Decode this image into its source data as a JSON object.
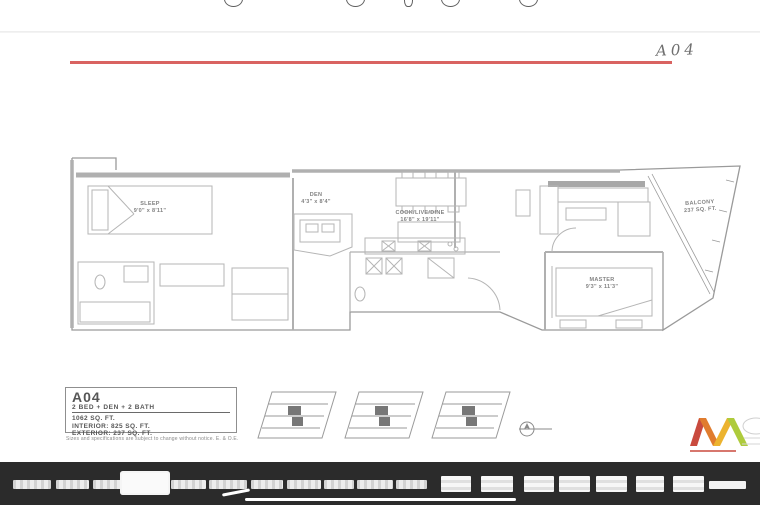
{
  "annotation": {
    "text": "A04"
  },
  "toolbar": {
    "icon_count": 5
  },
  "floorplan": {
    "accent_line_color": "#d96361",
    "rooms": {
      "sleep": {
        "name": "SLEEP",
        "dims": "9'0\" x 8'11\""
      },
      "den": {
        "name": "DEN",
        "dims": "4'3\" x 8'4\""
      },
      "cook": {
        "name": "COOK/LIVE/DINE",
        "dims": "16'8\" x 19'11\""
      },
      "master": {
        "name": "MASTER",
        "dims": "9'3\" x 11'3\""
      },
      "balcony": {
        "name": "BALCONY",
        "dims": "237 SQ. FT."
      }
    },
    "info_box": {
      "unit": "A04",
      "type": "2 BED + DEN + 2 BATH",
      "area": "1062 SQ. FT.",
      "interior": "INTERIOR: 825 SQ. FT.",
      "exterior": "EXTERIOR: 237 SQ. FT."
    },
    "disclaimer": "Sizes and specifications are subject to change without notice. E. & O.E."
  },
  "logo_colors": {
    "red": "#c94a3e",
    "orange": "#e07c2e",
    "yellow": "#ecb32f",
    "green": "#aecb3c"
  },
  "thumbnail_strip": {
    "bg": "#2b2b2b",
    "selected_index": 3,
    "items": [
      {
        "x": 13,
        "y": 18,
        "w": 38,
        "h": 9,
        "kind": "small"
      },
      {
        "x": 56,
        "y": 18,
        "w": 33,
        "h": 9,
        "kind": "small"
      },
      {
        "x": 93,
        "y": 18,
        "w": 28,
        "h": 9,
        "kind": "small"
      },
      {
        "x": 122,
        "y": 11,
        "w": 46,
        "h": 20,
        "kind": "selected"
      },
      {
        "x": 171,
        "y": 18,
        "w": 35,
        "h": 9,
        "kind": "small"
      },
      {
        "x": 209,
        "y": 18,
        "w": 38,
        "h": 9,
        "kind": "small"
      },
      {
        "x": 251,
        "y": 18,
        "w": 32,
        "h": 9,
        "kind": "small"
      },
      {
        "x": 287,
        "y": 18,
        "w": 34,
        "h": 9,
        "kind": "small"
      },
      {
        "x": 324,
        "y": 18,
        "w": 30,
        "h": 9,
        "kind": "small"
      },
      {
        "x": 357,
        "y": 18,
        "w": 36,
        "h": 9,
        "kind": "small"
      },
      {
        "x": 396,
        "y": 18,
        "w": 31,
        "h": 9,
        "kind": "small"
      },
      {
        "x": 441,
        "y": 14,
        "w": 30,
        "h": 16,
        "kind": "tall"
      },
      {
        "x": 481,
        "y": 14,
        "w": 32,
        "h": 16,
        "kind": "tall"
      },
      {
        "x": 524,
        "y": 14,
        "w": 30,
        "h": 16,
        "kind": "tall"
      },
      {
        "x": 559,
        "y": 14,
        "w": 31,
        "h": 16,
        "kind": "tall"
      },
      {
        "x": 596,
        "y": 14,
        "w": 31,
        "h": 16,
        "kind": "tall"
      },
      {
        "x": 636,
        "y": 14,
        "w": 28,
        "h": 16,
        "kind": "tall"
      },
      {
        "x": 673,
        "y": 14,
        "w": 31,
        "h": 16,
        "kind": "tall"
      },
      {
        "x": 709,
        "y": 19,
        "w": 37,
        "h": 8,
        "kind": "flat"
      }
    ]
  }
}
